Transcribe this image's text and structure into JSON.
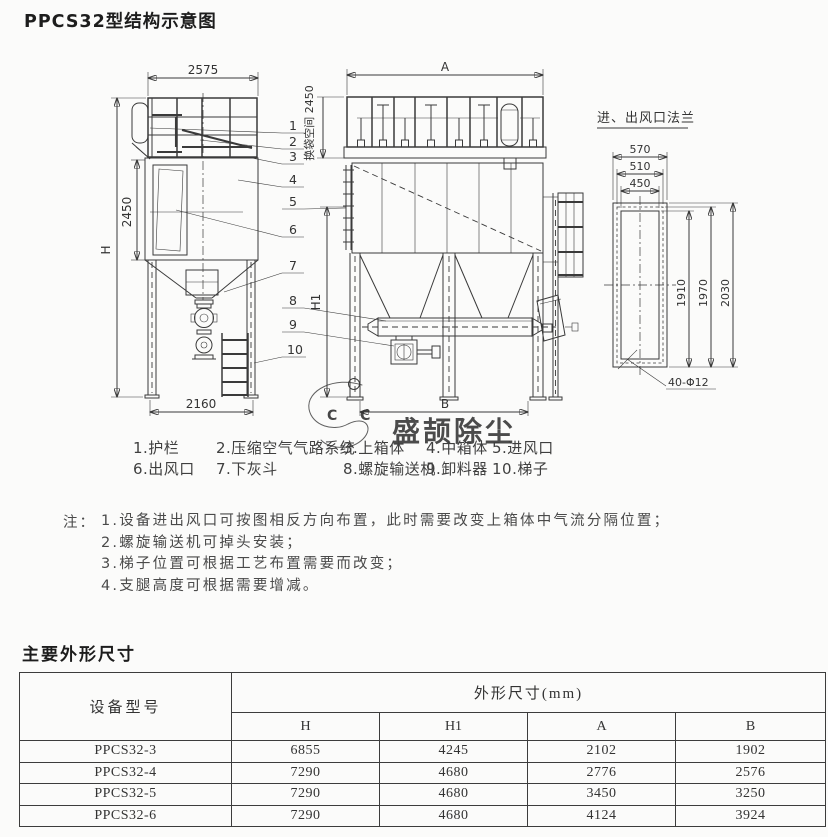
{
  "page": {
    "title": "PPCS32型结构示意图",
    "section2": "主要外形尺寸"
  },
  "drawing": {
    "flange_title": "进、出风口法兰",
    "dims": {
      "left_width": "2575",
      "left_height": "2450",
      "overall_height": "H",
      "left_base": "2160",
      "bag_space": "换袋空间 2450",
      "front_width": "A",
      "front_base": "B",
      "leg_height": "H1",
      "flange_w_outer": "570",
      "flange_w_mid": "510",
      "flange_w_inner": "450",
      "flange_h_inner": "1910",
      "flange_h_mid": "1970",
      "flange_h_outer": "2030",
      "flange_holes": "40-Φ12"
    },
    "callouts": [
      "1",
      "2",
      "3",
      "4",
      "5",
      "6",
      "7",
      "8",
      "9",
      "10"
    ]
  },
  "watermark": {
    "text": "盛颉除尘",
    "logo_letters": "C C",
    "colors": {
      "blue": "#9fd2ee",
      "green": "#7ade6e",
      "yellow": "#f0cf2a",
      "red": "#e23b2e"
    }
  },
  "parts": [
    "1.护栏",
    "2.压缩空气气路系统",
    "3.上箱体",
    "4.中箱体",
    "5.进风口",
    "6.出风口",
    "7.下灰斗",
    "8.螺旋输送机",
    "9.卸料器",
    "10.梯子"
  ],
  "notes": {
    "prefix": "注：",
    "items": [
      "1.设备进出风口可按图相反方向布置，此时需要改变上箱体中气流分隔位置；",
      "2.螺旋输送机可掉头安装；",
      "3.梯子位置可根据工艺布置需要而改变；",
      "4.支腿高度可根据需要增减。"
    ]
  },
  "table": {
    "col1_header": "设备型号",
    "group_header": "外形尺寸(mm)",
    "columns": [
      "H",
      "H1",
      "A",
      "B"
    ],
    "rows": [
      {
        "model": "PPCS32-3",
        "values": [
          "6855",
          "4245",
          "2102",
          "1902"
        ]
      },
      {
        "model": "PPCS32-4",
        "values": [
          "7290",
          "4680",
          "2776",
          "2576"
        ]
      },
      {
        "model": "PPCS32-5",
        "values": [
          "7290",
          "4680",
          "3450",
          "3250"
        ]
      },
      {
        "model": "PPCS32-6",
        "values": [
          "7290",
          "4680",
          "4124",
          "3924"
        ]
      }
    ]
  }
}
